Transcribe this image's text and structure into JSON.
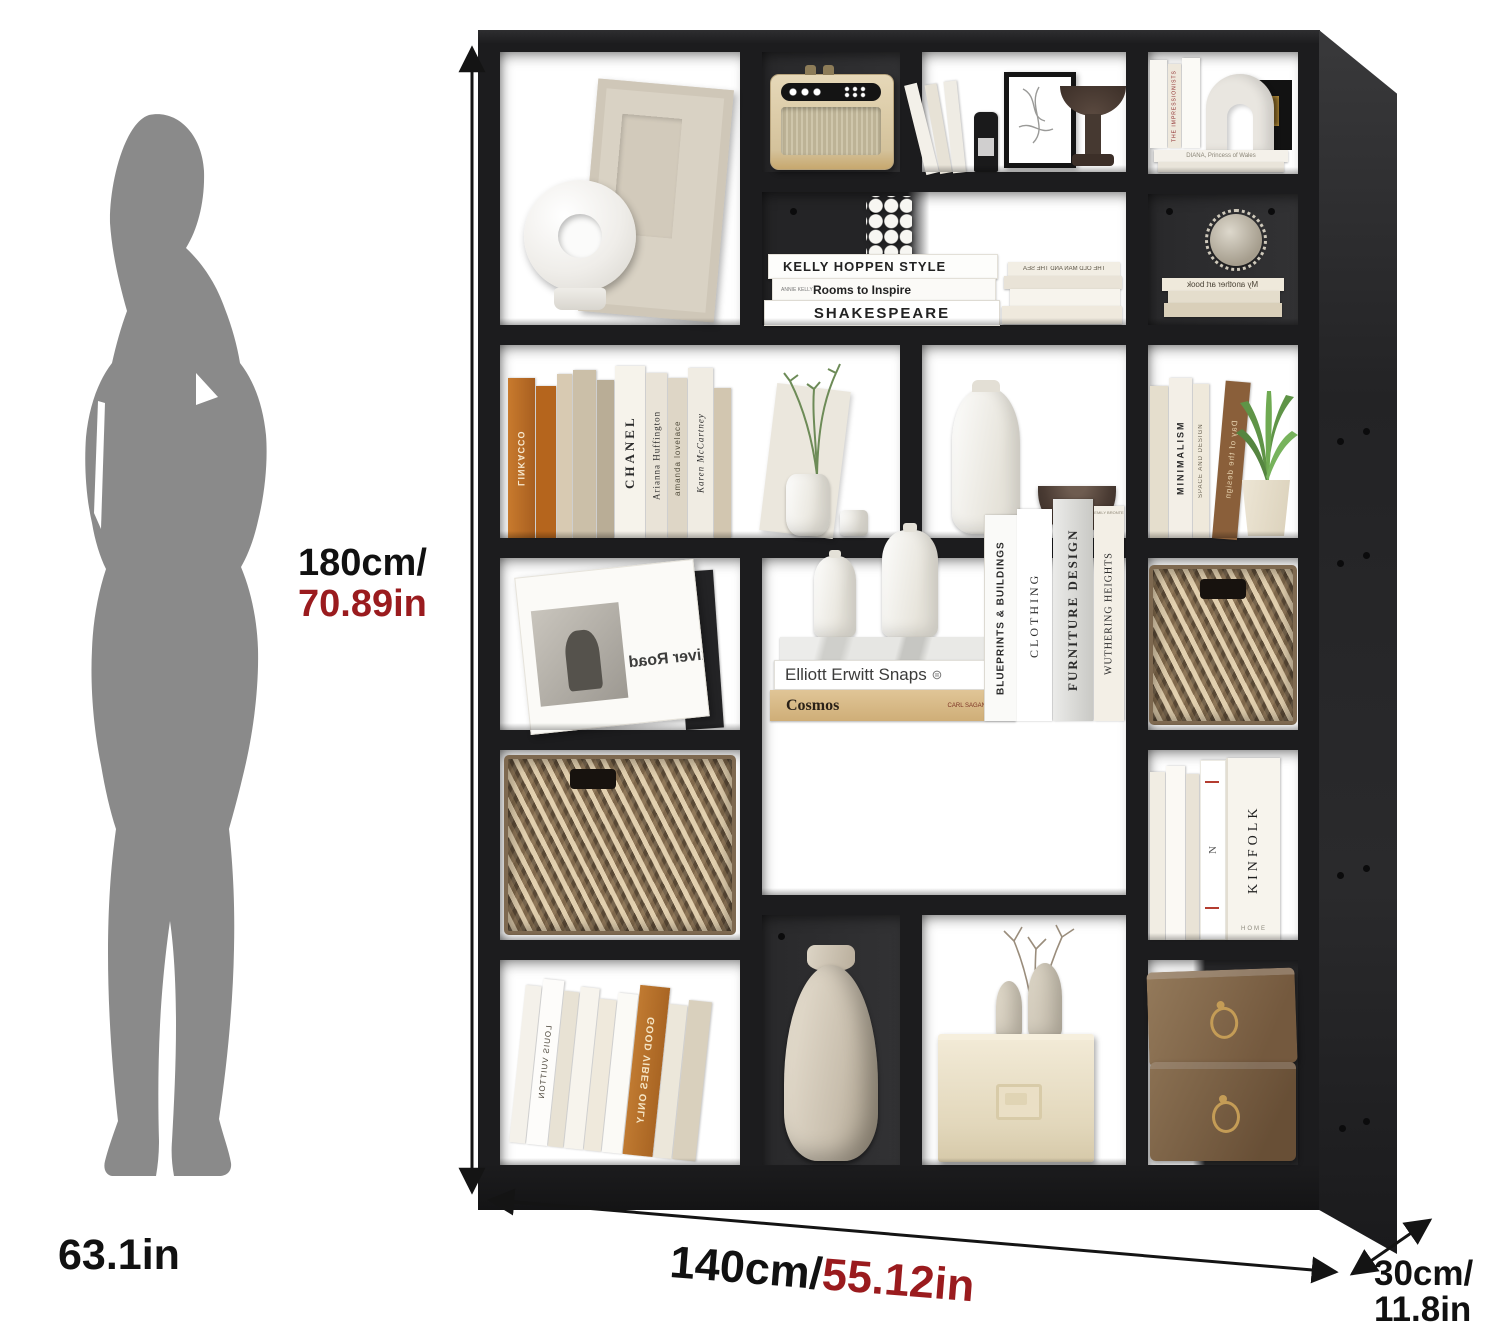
{
  "annotations": {
    "height": {
      "metric": "180cm/",
      "imperial": "70.89in"
    },
    "width": {
      "metric": "140cm/",
      "imperial": "55.12in"
    },
    "depth": {
      "metric": "30cm/",
      "imperial": "11.8in"
    },
    "person_height": "63.1in"
  },
  "colors": {
    "accent_red": "#9a1b1e",
    "shelf_black": "#1c1c1e",
    "silhouette_gray": "#8a8a8a",
    "background": "#ffffff"
  },
  "decor": {
    "kelly": "KELLY HOPPEN STYLE",
    "rooms_author": "ANNIE KELLY",
    "rooms": "Rooms to Inspire",
    "shakespeare": "SHAKESPEARE",
    "old_man": "THE OLD MAN AND THE SEA",
    "impressionists": "THE IMPRESSIONISTS",
    "diana": "DIANA, Princess of Wales",
    "another_art": "My another art book",
    "chanel_sub": "LITTLE BOOK OF",
    "chanel": "CHANEL",
    "arianna": "Arianna Huffington",
    "amanda": "amanda lovelace",
    "karen": "Karen McCartney",
    "linkacco": "LINKACCO",
    "minimalism": "MINIMALISM",
    "space_design": "SPACE AND DESIGN",
    "day_design": "Day of the design",
    "river_road": "River Road",
    "elliott": "Elliott Erwitt Snaps",
    "elliott_icon": "⊜",
    "cosmos": "Cosmos",
    "sagan": "CARL SAGAN",
    "blueprints": "BLUEPRINTS & BUILDINGS",
    "clothing": "CLOTHING",
    "furniture": "FURNITURE DESIGN",
    "wuthering": "WUTHERING HEIGHTS",
    "bronte": "EMILY BRONTE",
    "kinfolk_n": "N",
    "kinfolk": "KINFOLK",
    "kinfolk_home": "HOME",
    "good_vibes": "GOOD VIBES ONLY",
    "louis": "LOUIS VUITTON"
  }
}
